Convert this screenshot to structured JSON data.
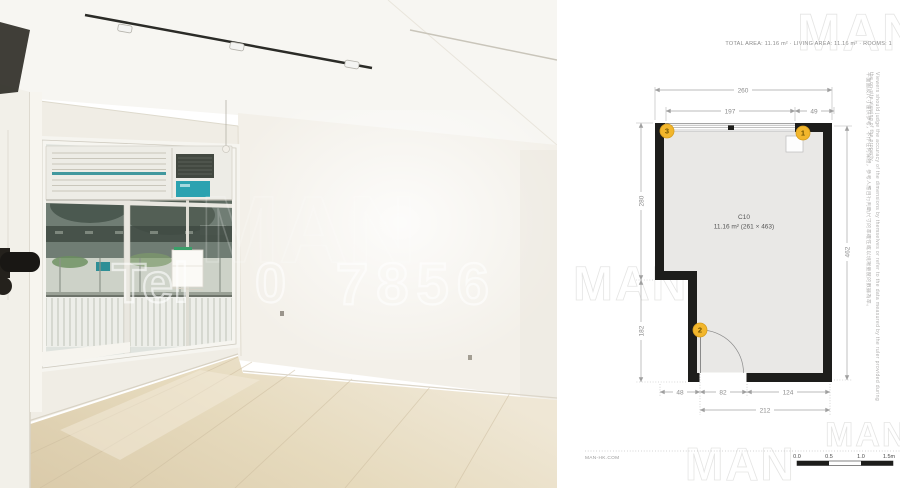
{
  "header": {
    "stats_line": "TOTAL AREA: 11.16 m² · LIVING AREA: 11.16 m² · ROOMS: 1"
  },
  "photo": {
    "watermark": {
      "part1": "Tel",
      "part2": "0",
      "part3": "7856",
      "logo": "MAN"
    }
  },
  "floorplan": {
    "unit_label": "C10",
    "area_label": "11.16 m² (261 × 463)",
    "dimensions": {
      "top_total": "260",
      "top_window": "197",
      "top_corner": "49",
      "left_upper": "280",
      "left_lower": "182",
      "right_full": "462",
      "bottom_notch": "48",
      "bottom_door": "82",
      "bottom_wall": "124",
      "bottom_total": "212"
    },
    "markers": {
      "m1": "1",
      "m2": "2",
      "m3": "3"
    },
    "scale_bar": {
      "t0": "0.0",
      "t1": "0.5",
      "t2": "1.0",
      "t3": "1.5m"
    },
    "site_label": "MAN-HK.COM",
    "watermark_logo": "MAN",
    "disclaimer_en": "Viewers should judge the accuracy of the dimensions by themselves or refer to the data measured by the ruler provided during the on-site viewing of the property.",
    "disclaimer_zh": "平面圖及尺寸僅供參考，不作任何保證，參考人應自行判斷尺寸的準確性或以現場量度的數據為準。"
  },
  "colors": {
    "marker_yellow": "#F2B62C",
    "wall_black": "#1D1D1B",
    "interior_gray": "#E9E8E6",
    "dim_gray": "#9A9A9A",
    "accent_teal": "#2E8F96"
  }
}
